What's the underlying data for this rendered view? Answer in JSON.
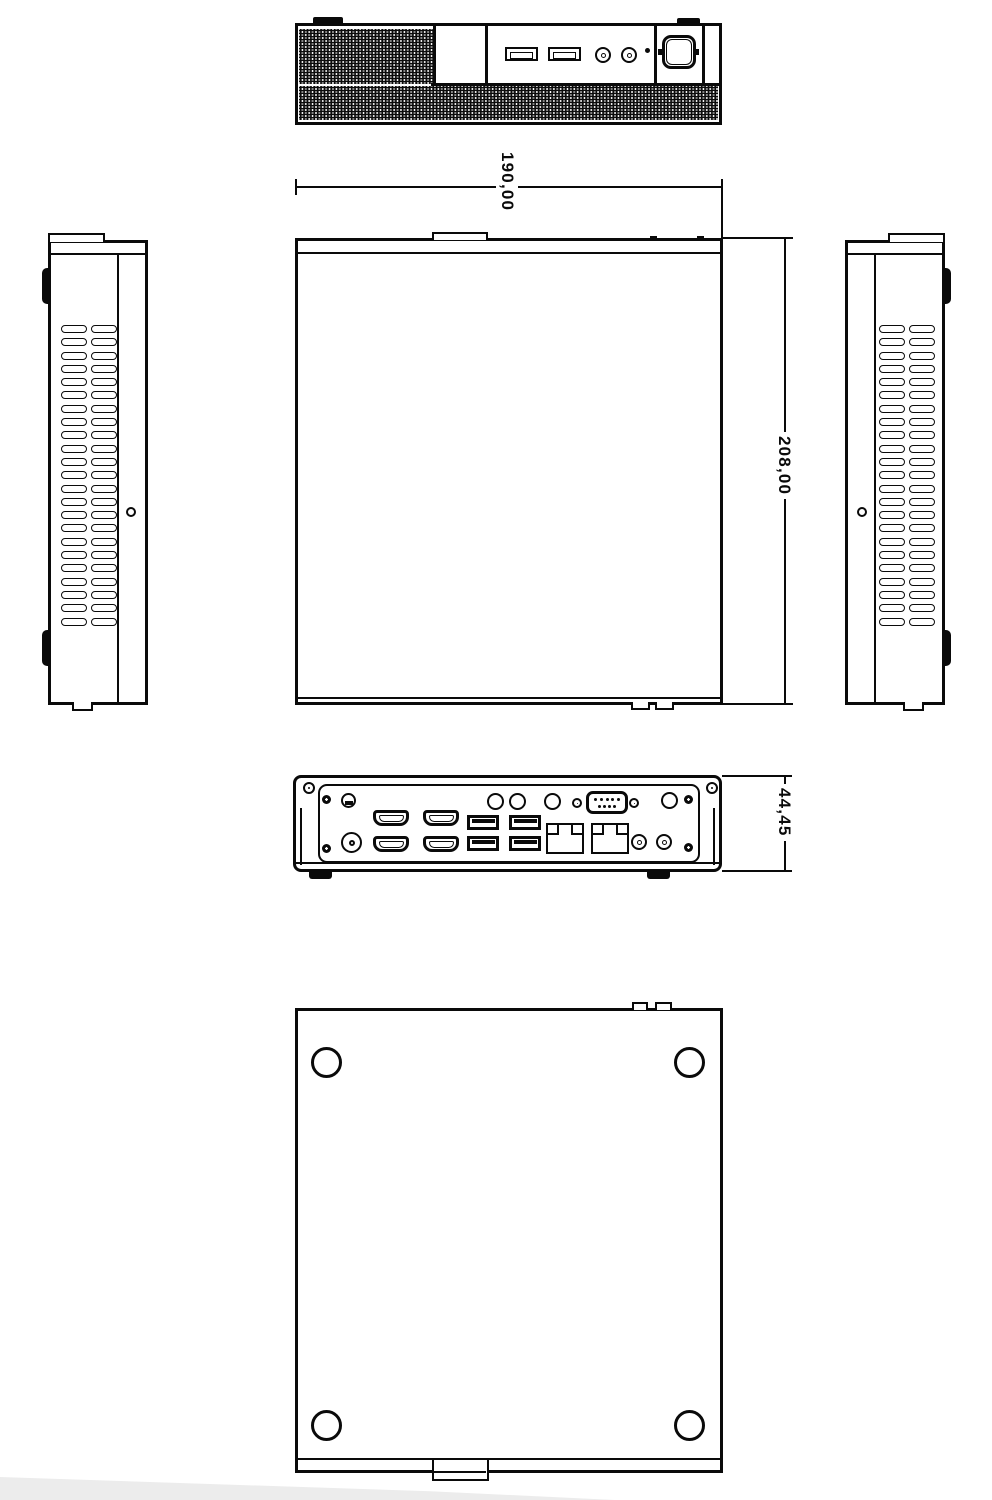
{
  "dimensions": {
    "width_mm": "190,00",
    "depth_mm": "208,00",
    "height_mm": "44,45"
  },
  "colors": {
    "line": "#0a0a0a",
    "background": "#ffffff",
    "watermark": "#ececec"
  },
  "views": {
    "front": {
      "label": "front-panel-view",
      "ports": [
        "usb-a",
        "usb-a",
        "mic-jack",
        "line-jack",
        "power-led",
        "power-button"
      ]
    },
    "top": {
      "label": "top-view"
    },
    "left_side": {
      "label": "left-side-view",
      "vent_slot_count": 46
    },
    "right_side": {
      "label": "right-side-view",
      "vent_slot_count": 46
    },
    "rear": {
      "label": "rear-panel-view",
      "db9_pins_top": 5,
      "db9_pins_bottom": 4,
      "ports": [
        "dc-jack",
        "lock-slot",
        "hdmi",
        "hdmi",
        "hdmi",
        "hdmi",
        "usb-a",
        "usb-a",
        "usb-a",
        "usb-a",
        "rj45-lan",
        "rj45-lan",
        "audio-jack",
        "audio-jack",
        "com-db9",
        "antenna-hole",
        "antenna-hole",
        "antenna-hole",
        "antenna-hole"
      ]
    },
    "bottom": {
      "label": "bottom-view",
      "mount_hole_count": 4
    }
  }
}
